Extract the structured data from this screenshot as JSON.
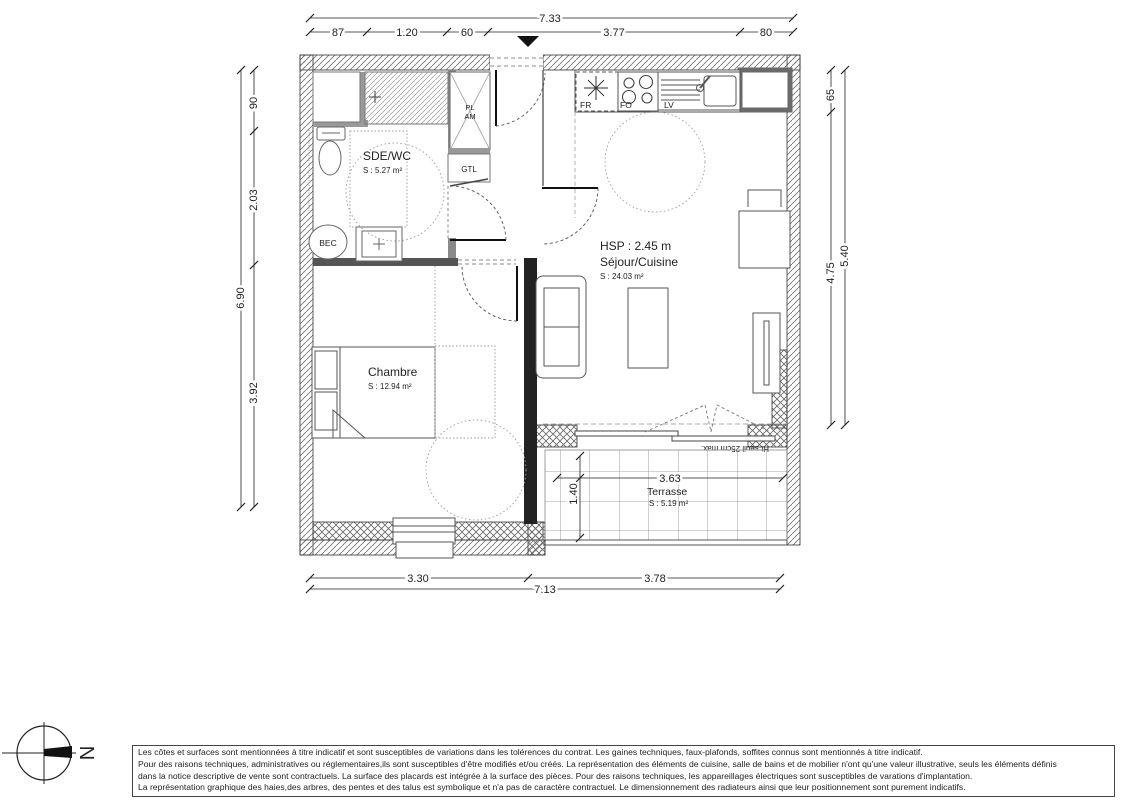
{
  "rooms": {
    "sde_wc": {
      "name": "SDE/WC",
      "area": "S : 5.27 m²"
    },
    "sejour": {
      "hsp": "HSP : 2.45 m",
      "name": "Séjour/Cuisine",
      "area": "S : 24.03 m²"
    },
    "chambre": {
      "name": "Chambre",
      "area": "S : 12.94 m²"
    },
    "terrasse": {
      "name": "Terrasse",
      "area": "S : 5.19 m²",
      "width": "3.63",
      "depth": "1.40"
    }
  },
  "fixtures": {
    "fridge": "FR",
    "oven": "FO",
    "dishwasher": "LV",
    "closet_line1": "PL",
    "closet_line2": "AM",
    "gtl": "GTL",
    "bec": "BEC",
    "threshold_note": "Ht seuil 25cm max."
  },
  "dimensions": {
    "top": {
      "total": "7.33",
      "segments": [
        "87",
        "1.20",
        "60",
        "3.77",
        "80"
      ]
    },
    "left": {
      "total": "6.90",
      "segments": [
        "90",
        "2.03",
        "3.92"
      ]
    },
    "right": {
      "total": "5.40",
      "segments": [
        "65",
        "4.75"
      ]
    },
    "bottom": {
      "total": "7.13",
      "segments": [
        "3.30",
        "3.78"
      ]
    }
  },
  "compass": {
    "north": "N"
  },
  "disclaimer": {
    "line1": "Les côtes et surfaces sont mentionnées à titre indicatif et sont susceptibles de variations dans les tolérences du contrat. Les gaines techniques, faux-plafonds, soffites connus sont mentionnés à titre indicatif.",
    "line2": "Pour des raisons techniques, administratives ou réglementaires,ils sont susceptibles d'être modifiés et/ou créés. La représentation des éléments de cuisine, salle de bains et de mobilier n'ont qu'une valeur illustrative, seuls les éléments définis",
    "line3": "dans la notice descriptive de vente sont contractuels. La surface des placards est intégrée à la surface des pièces. Pour des raisons techniques, les appareillages électriques sont susceptibles  de varations d'implantation.",
    "line4": "La représentation graphique  des haies,des arbres, des pentes et des talus est  symbolique et n'a pas de caractère contractuel. Le dimensionnement des radiateurs ainsi que leur positionnement sont purement indicatifs."
  }
}
